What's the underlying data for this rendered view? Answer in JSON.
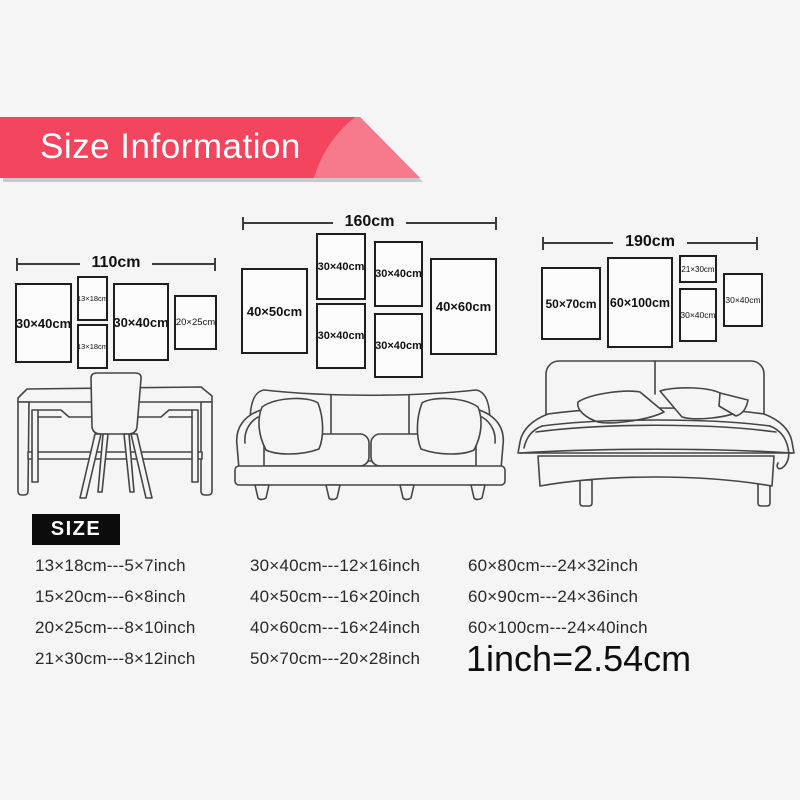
{
  "banner": {
    "title": "Size Information",
    "color": "#f4455e",
    "highlight_color": "#f7798c",
    "shadow_color": "#c9c9c9"
  },
  "size_heading": "SIZE",
  "size_heading_bg": "#0c0c0c",
  "conversion_note": "1inch=2.54cm",
  "wall_groups": [
    {
      "name": "desk-wall",
      "total_width_label": "110cm",
      "dim": {
        "x": 16,
        "y": 257,
        "w": 200
      },
      "frames": [
        {
          "label": "30×40cm",
          "x": 15,
          "y": 283,
          "w": 57,
          "h": 80,
          "fs": 13,
          "fw": 700
        },
        {
          "label": "13×18cm",
          "x": 77,
          "y": 276,
          "w": 31,
          "h": 45,
          "fs": 7.5,
          "fw": 400
        },
        {
          "label": "13×18cm",
          "x": 77,
          "y": 324,
          "w": 31,
          "h": 45,
          "fs": 7.5,
          "fw": 400
        },
        {
          "label": "30×40cm",
          "x": 113,
          "y": 283,
          "w": 56,
          "h": 78,
          "fs": 13,
          "fw": 700
        },
        {
          "label": "20×25cm",
          "x": 174,
          "y": 295,
          "w": 43,
          "h": 55,
          "fs": 9.5,
          "fw": 400
        }
      ]
    },
    {
      "name": "sofa-wall",
      "total_width_label": "160cm",
      "dim": {
        "x": 242,
        "y": 216,
        "w": 255
      },
      "frames": [
        {
          "label": "40×50cm",
          "x": 241,
          "y": 268,
          "w": 67,
          "h": 86,
          "fs": 13,
          "fw": 700
        },
        {
          "label": "30×40cm",
          "x": 316,
          "y": 233,
          "w": 50,
          "h": 67,
          "fs": 11,
          "fw": 700
        },
        {
          "label": "30×40cm",
          "x": 316,
          "y": 303,
          "w": 50,
          "h": 66,
          "fs": 11,
          "fw": 700
        },
        {
          "label": "30×40cm",
          "x": 374,
          "y": 241,
          "w": 49,
          "h": 66,
          "fs": 11,
          "fw": 700
        },
        {
          "label": "30×40cm",
          "x": 374,
          "y": 313,
          "w": 49,
          "h": 65,
          "fs": 11,
          "fw": 700
        },
        {
          "label": "40×60cm",
          "x": 430,
          "y": 258,
          "w": 67,
          "h": 97,
          "fs": 13,
          "fw": 700
        }
      ]
    },
    {
      "name": "bed-wall",
      "total_width_label": "190cm",
      "dim": {
        "x": 542,
        "y": 236,
        "w": 216
      },
      "frames": [
        {
          "label": "50×70cm",
          "x": 541,
          "y": 267,
          "w": 60,
          "h": 73,
          "fs": 12,
          "fw": 700
        },
        {
          "label": "60×100cm",
          "x": 607,
          "y": 257,
          "w": 66,
          "h": 91,
          "fs": 12.5,
          "fw": 700
        },
        {
          "label": "21×30cm",
          "x": 679,
          "y": 255,
          "w": 38,
          "h": 28,
          "fs": 8,
          "fw": 400
        },
        {
          "label": "30×40cm",
          "x": 679,
          "y": 288,
          "w": 38,
          "h": 54,
          "fs": 8.5,
          "fw": 400
        },
        {
          "label": "30×40cm",
          "x": 723,
          "y": 273,
          "w": 40,
          "h": 54,
          "fs": 8.5,
          "fw": 400
        }
      ]
    }
  ],
  "size_table": {
    "columns": [
      [
        "13×18cm---5×7inch",
        "15×20cm---6×8inch",
        "20×25cm---8×10inch",
        "21×30cm---8×12inch"
      ],
      [
        "30×40cm---12×16inch",
        "40×50cm---16×20inch",
        "40×60cm---16×24inch",
        "50×70cm---20×28inch"
      ],
      [
        "60×80cm---24×32inch",
        "60×90cm---24×36inch",
        "60×100cm---24×40inch"
      ]
    ]
  }
}
